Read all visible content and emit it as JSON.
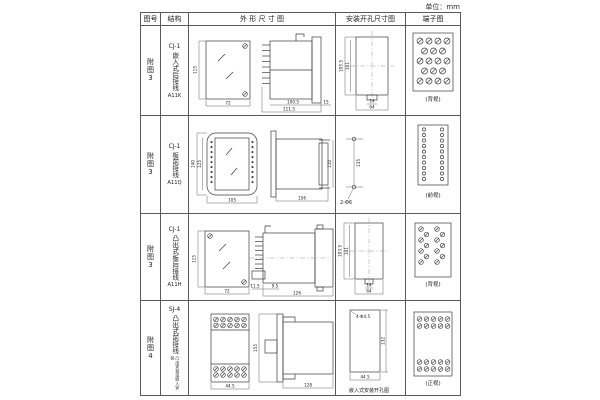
{
  "units_label": "单位：mm",
  "headers": {
    "fig_no": "图号",
    "structure": "结构",
    "outline": "外 形 尺 寸 图",
    "install": "安装开孔尺寸图",
    "terminal": "端子图"
  },
  "rows": [
    {
      "fig_no": "附图3",
      "model": "CJ-1",
      "desc": "嵌入式后接线",
      "code": "A11K",
      "outline": {
        "front_h": "115",
        "front_w": "72",
        "body_w": "100.5",
        "total_w": "111.5",
        "flange_w": "15"
      },
      "install": {
        "v1": "105.5",
        "v2": "101",
        "b1": "14",
        "b2": "64"
      },
      "terminal": {
        "caption": "(背视)"
      }
    },
    {
      "fig_no": "附图3",
      "model": "CJ-1",
      "desc": "板前接线",
      "code": "A11Q",
      "outline": {
        "front_h1": "140",
        "front_h2": "125",
        "front_w": "105",
        "side_w": "156",
        "side_h": "110"
      },
      "install": {
        "v1": "135",
        "hole": "2-Φ6"
      },
      "terminal": {
        "caption": "(前视)"
      }
    },
    {
      "fig_no": "附图3",
      "model": "CJ-1",
      "desc": "凸出式板后接线",
      "code": "A11H",
      "outline": {
        "front_h": "115",
        "front_w": "72",
        "pedestal_w": "11.5",
        "gap_w": "9.5",
        "total_w": "126"
      },
      "install": {
        "v1": "103.5",
        "v2": "101",
        "b1": "14",
        "b2": "64"
      },
      "terminal": {
        "caption": "(背视)"
      }
    },
    {
      "fig_no": "附图4",
      "model": "SJ-4",
      "desc": "凸出式前接线",
      "note": "凸出安装或嵌入安装",
      "outline": {
        "front_w": "44.5",
        "side_h": "155",
        "side_w": "128"
      },
      "install": {
        "hole": "4-Φ4.5",
        "v1": "132",
        "b1": "44.5",
        "caption": "嵌入式安装开孔图"
      },
      "terminal": {
        "caption": "(正视)"
      }
    }
  ]
}
